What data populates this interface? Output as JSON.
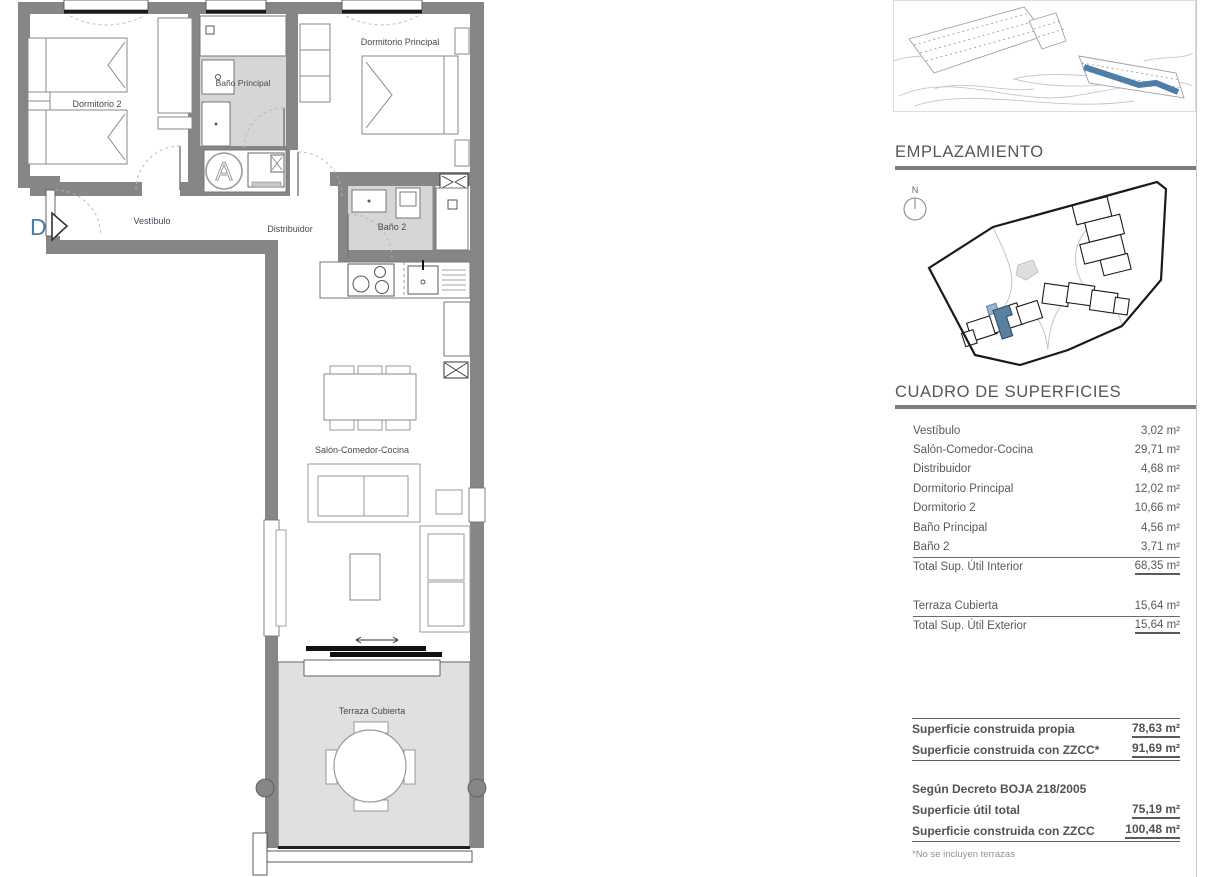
{
  "floorplan": {
    "unit_marker": "D",
    "core_marker": "A",
    "rooms": {
      "dormitorio2": "Dormitorio 2",
      "bano_principal": "Baño Principal",
      "dormitorio_principal": "Dormitorio Principal",
      "vestibulo": "Vestíbulo",
      "distribuidor": "Distribuidor",
      "bano2": "Baño 2",
      "salon": "Salón-Comedor-Cocina",
      "terraza": "Terraza Cubierta"
    }
  },
  "sidebar": {
    "emplazamiento": {
      "title": "EMPLAZAMIENTO",
      "north_label": "N"
    },
    "superficies": {
      "title": "CUADRO DE SUPERFICIES",
      "rows": [
        {
          "label": "Vestíbulo",
          "value": "3,02 m²"
        },
        {
          "label": "Salón-Comedor-Cocina",
          "value": "29,71 m²"
        },
        {
          "label": "Distribuidor",
          "value": "4,68 m²"
        },
        {
          "label": "Dormitorio Principal",
          "value": "12,02 m²"
        },
        {
          "label": "Dormitorio 2",
          "value": "10,66 m²"
        },
        {
          "label": "Baño Principal",
          "value": "4,56 m²"
        },
        {
          "label": "Baño 2",
          "value": "3,71 m²"
        }
      ],
      "total_interior": {
        "label": "Total Sup. Útil Interior",
        "value": "68,35 m²"
      },
      "terraza": {
        "label": "Terraza Cubierta",
        "value": "15,64 m²"
      },
      "total_exterior": {
        "label": "Total Sup. Útil Exterior",
        "value": "15,64 m²"
      }
    },
    "resumen": {
      "construida_propia": {
        "label": "Superficie construida propia",
        "value": "78,63 m²"
      },
      "construida_zzcc_asterisk": {
        "label": "Superficie construida con ZZCC*",
        "value": "91,69 m²"
      },
      "decreto_heading": "Según Decreto BOJA 218/2005",
      "util_total": {
        "label": "Superficie útil total",
        "value": "75,19 m²"
      },
      "construida_zzcc": {
        "label": "Superficie construida con ZZCC",
        "value": "100,48 m²"
      },
      "footnote": "*No se incluyen terrazas"
    }
  },
  "colors": {
    "accent_blue": "#4a7ca8",
    "siteplan_highlight": "#5b7f9e",
    "wall_gray": "#868686",
    "wet_floor_gray": "#d6d6d6",
    "terrace_floor_gray": "#e0e0e0",
    "heading_gray": "#55565a"
  }
}
